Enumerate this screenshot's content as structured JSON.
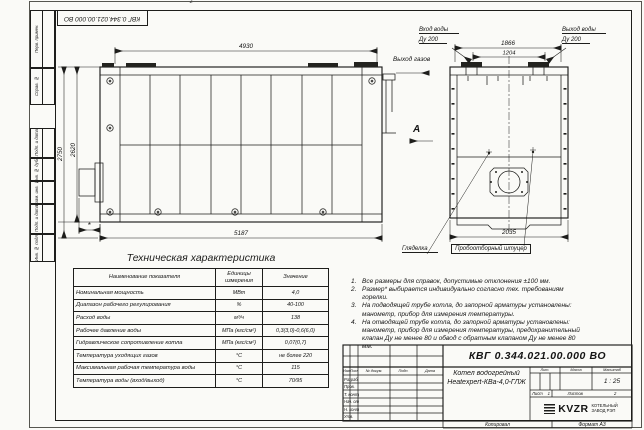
{
  "page": {
    "zone_marker": "2"
  },
  "colors": {
    "line": "#1d1d1b",
    "paper": "#fafaf7"
  },
  "top_stamp": {
    "doc_number": "КВГ 0.344.021.00.000 ВО"
  },
  "margin": {
    "blocks": [
      {
        "label": "Перв. примен."
      },
      {
        "label": "Справ. №"
      },
      {
        "label": "Подп. и дата"
      },
      {
        "label": "Инв. № дубл."
      },
      {
        "label": "Взам. инв. №"
      },
      {
        "label": "Подп. и дата"
      },
      {
        "label": "Инв. № подл."
      }
    ]
  },
  "side_view": {
    "dims": {
      "width_top": "4930",
      "width_bottom": "5187",
      "height_outer": "2750",
      "height_inner": "2620",
      "burner_dim": "*"
    },
    "labels": {
      "gas_outlet": "Выход газов",
      "view_marker": "A"
    }
  },
  "end_view": {
    "dims": {
      "flange_span": "1866",
      "flange_pitch": "1204",
      "width": "2035"
    },
    "labels": {
      "water_inlet": "Вход воды",
      "water_inlet_dn": "Ду 200",
      "water_outlet": "Выход воды",
      "water_outlet_dn": "Ду 200",
      "sight_glass": "Гляделка",
      "sampling_fitting": "Пробоотборный штуцер"
    }
  },
  "table": {
    "title": "Техническая характеристика",
    "headers": [
      "Наименование показателя",
      "Единицы измерения",
      "Значение"
    ],
    "rows": [
      [
        "Номинальная мощность",
        "МВт",
        "4,0"
      ],
      [
        "Диапазон рабочего регулирования",
        "%",
        "40-100"
      ],
      [
        "Расход воды",
        "м³/ч",
        "138"
      ],
      [
        "Рабочее давление воды",
        "МПа (кгс/см²)",
        "0,3(3,0)-0,6(6,0)"
      ],
      [
        "Гидравлическое сопротивление котла",
        "МПа (кгс/см²)",
        "0,07(0,7)"
      ],
      [
        "Температура уходящих газов",
        "°С",
        "не более 220"
      ],
      [
        "Максимальная рабочая температура воды",
        "°С",
        "115"
      ],
      [
        "Температура воды (вход/выход)",
        "°С",
        "70/95"
      ]
    ]
  },
  "notes": [
    {
      "num": "1.",
      "text": "Все размеры для справок, допустимые отклонения ±100 мм."
    },
    {
      "num": "2.",
      "text": "Размер* выбирается индивидуально согласно тех. требованиям горелки."
    },
    {
      "num": "3.",
      "text": "На подводящей трубе котла, до запорной арматуры установлены: манометр, прибор для измерения температуры."
    },
    {
      "num": "4.",
      "text": "На отводящей трубе котла, до запорной арматуры установлены: манометр, прибор для измерения температуры, предохранительный клапан Ду не менее 80 и обвод с обратным клапаном Ду не менее 80 мм."
    }
  ],
  "title_block": {
    "doc_number": "КВГ 0.344.021.00.000 ВО",
    "name_line1": "Котел водогрейный",
    "name_line2": "Heatexpert-КВа-4,0-ГЛЖ",
    "header_cols": [
      "Изм.",
      "Лист",
      "№ докум.",
      "Подп.",
      "Дата"
    ],
    "row_labels": [
      "Разраб.",
      "Пров.",
      "Т. контр.",
      "Нач. отд.",
      "Н. контр.",
      "Утв."
    ],
    "lit_label": "Лит.",
    "mass_label": "Масса",
    "scale_label": "Масштаб",
    "scale_value": "1 : 25",
    "sheet_label": "Лист",
    "sheet_value": "1",
    "sheets_label": "Листов",
    "sheets_value": "2",
    "logo_text": "KVZR",
    "logo_line1": "КОТЕЛЬНЫЙ",
    "logo_line2": "ЗАВОД РЭП",
    "copied_label": "Копировал",
    "format_label": "Формат А3"
  }
}
